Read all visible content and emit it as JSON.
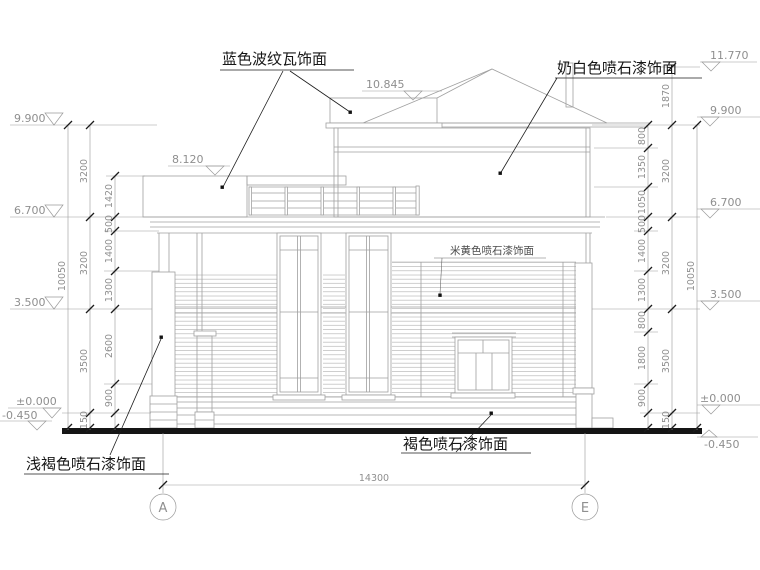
{
  "drawing": {
    "title_labels": {
      "blue_tile": "蓝色波纹瓦饰面",
      "milky_white": "奶白色喷石漆饰面",
      "beige": "米黄色喷石漆饰面",
      "brown": "褐色喷石漆饰面",
      "light_brown": "浅褐色喷石漆饰面"
    },
    "elevations": {
      "peak": "11.770",
      "upper_roof": "10.845",
      "lower_roof": "8.120",
      "third": "9.900",
      "second": "6.700",
      "first": "3.500",
      "zero": "±0.000",
      "ground": "-0.450"
    },
    "dimensions": {
      "left_inner": [
        "1420",
        "500",
        "1400",
        "1300",
        "2600",
        "900"
      ],
      "left_floors": [
        "3200",
        "3200",
        "3500",
        "150"
      ],
      "left_total": "10050",
      "right_inner": [
        "800",
        "1350",
        "1050",
        "500",
        "1400",
        "1300",
        "800",
        "1800",
        "900"
      ],
      "right_floors": [
        "1870",
        "3200",
        "3200",
        "3500",
        "150"
      ],
      "right_total": "10050",
      "overall_width": "14300"
    },
    "axes": {
      "left": "A",
      "right": "E"
    },
    "colors": {
      "line": "#a0a0a0",
      "dim_text": "#8f8f8f",
      "ink": "#161616"
    }
  }
}
